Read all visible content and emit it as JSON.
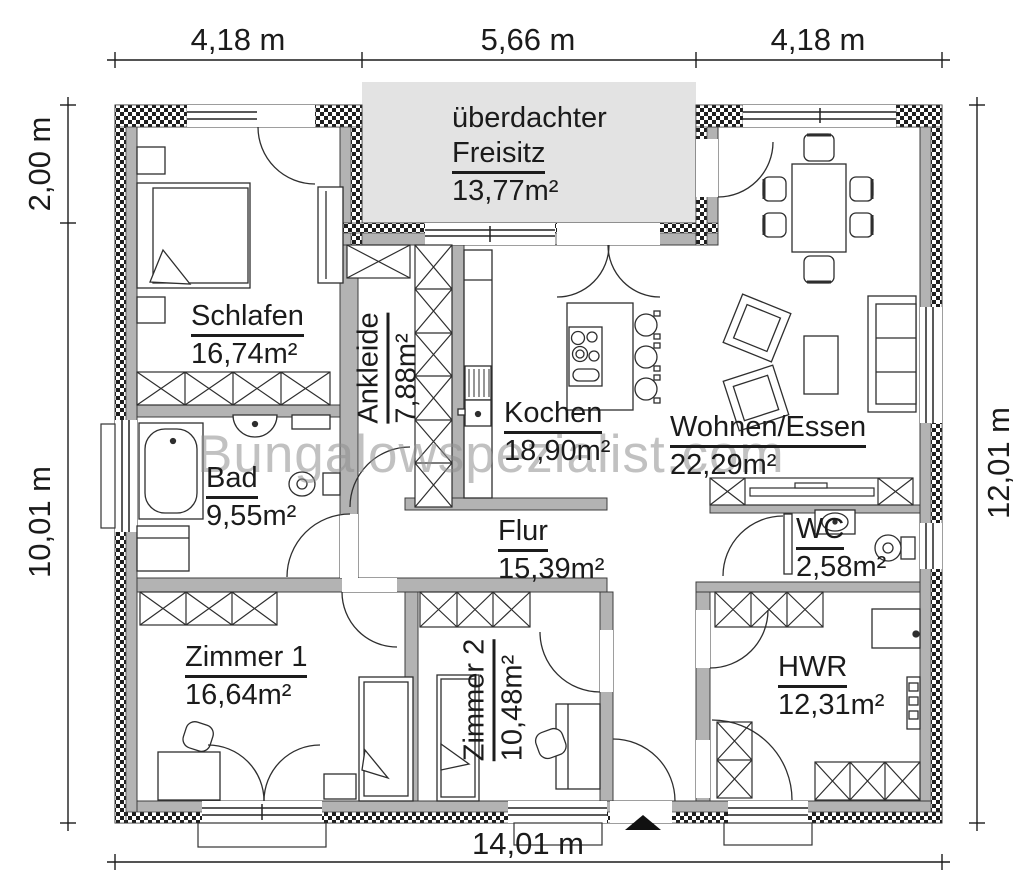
{
  "watermark": "Bungalowspezialist.com",
  "dimensions": {
    "top": [
      "4,18 m",
      "5,66 m",
      "4,18 m"
    ],
    "left": [
      "2,00 m",
      "10,01 m"
    ],
    "right": "12,01 m",
    "bottom": "14,01 m"
  },
  "rooms": {
    "freisitz": {
      "prefix": "überdachter",
      "name": "Freisitz",
      "area": "13,77m²"
    },
    "schlafen": {
      "name": "Schlafen",
      "area": "16,74m²"
    },
    "ankleide": {
      "name": "Ankleide",
      "area": "7,88m²"
    },
    "kochen": {
      "name": "Kochen",
      "area": "18,90m²"
    },
    "wohnen_essen": {
      "name": "Wohnen/Essen",
      "area": "22,29m²"
    },
    "bad": {
      "name": "Bad",
      "area": "9,55m²"
    },
    "flur": {
      "name": "Flur",
      "area": "15,39m²"
    },
    "wc": {
      "name": "WC",
      "area": "2,58m²"
    },
    "zimmer1": {
      "name": "Zimmer 1",
      "area": "16,64m²"
    },
    "zimmer2": {
      "name": "Zimmer 2",
      "area": "10,48m²"
    },
    "hwr": {
      "name": "HWR",
      "area": "12,31m²"
    }
  },
  "colors": {
    "wall": "#b3b3b3",
    "terrace": "#e3e3e3",
    "line": "#2e2e2e",
    "watermark": "#8f8f8f"
  }
}
